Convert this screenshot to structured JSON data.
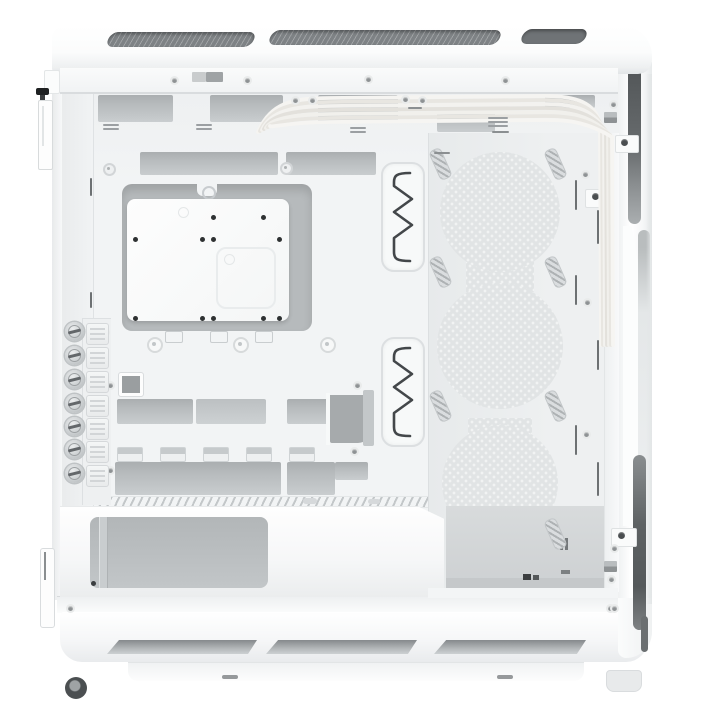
{
  "image": {
    "subject": "White mid-tower PC case with side panel removed, interior side view",
    "style": "studio product photo on white background",
    "orientation": "rear panel at left, front panel at right, PSU shroud at bottom"
  },
  "colors": {
    "case_white": "#fcfdfd",
    "panel_edge": "#e3e6e8",
    "interior": "#f2f4f5",
    "cutout": "#b7bbbd",
    "cutout_light": "#c9cdcf",
    "dark": "#5d6163",
    "mesh": "#7e8285",
    "pattern_base": "#e1e4e5",
    "pattern_dot": "#f1f3f3",
    "cable": "#f2f1ee",
    "screw": "#8e9294",
    "ink": "#2e3132"
  },
  "components": {
    "top_panel": {
      "vent_slots": 3
    },
    "rear_expansion_slots": {
      "thumbscrews": 7,
      "vented_covers": 7
    },
    "motherboard_tray": {
      "cpu_cutout": 1,
      "rubber_cable_grommets": 2,
      "standoff_dots": 11,
      "top_cable_cutouts": 3,
      "mid_cable_cutouts": 3,
      "bottom_cutouts": 3
    },
    "front_fan_mount": {
      "perforated_circles": 3,
      "slotted_mount_cutouts": 7
    },
    "psu_bay": {
      "openings": 1
    },
    "bottom_base": {
      "vent_slots": 3,
      "feet": 2
    },
    "cables": {
      "sleeved_strands": 7,
      "color": "white"
    }
  }
}
